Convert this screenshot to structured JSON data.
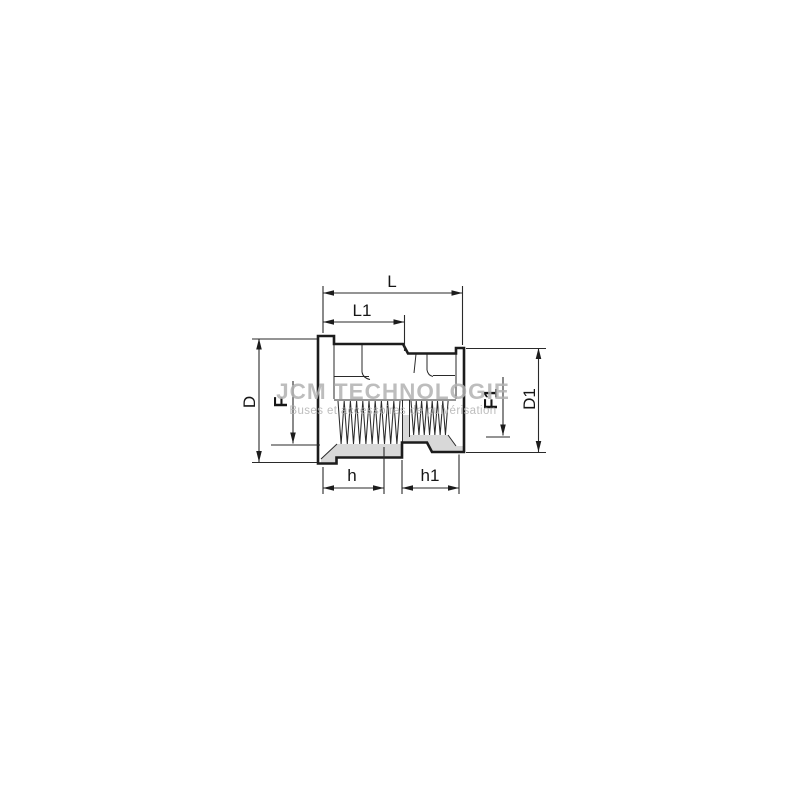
{
  "drawing": {
    "title": "threaded-reducing-socket-dimension-drawing",
    "watermark": {
      "brand": "JCM TECHNOLOGIE",
      "tagline": "Buses et accessoires de pulvérisation"
    },
    "dimension_labels": {
      "L": "L",
      "L1": "L1",
      "D": "D",
      "F": "F",
      "F1": "F1",
      "D1": "D1",
      "h": "h",
      "h1": "h1"
    },
    "colors": {
      "line": "#1c1c1c",
      "section_fill": "#d8d8d8",
      "watermark": "#b2b2b2",
      "background": "#ffffff"
    }
  }
}
